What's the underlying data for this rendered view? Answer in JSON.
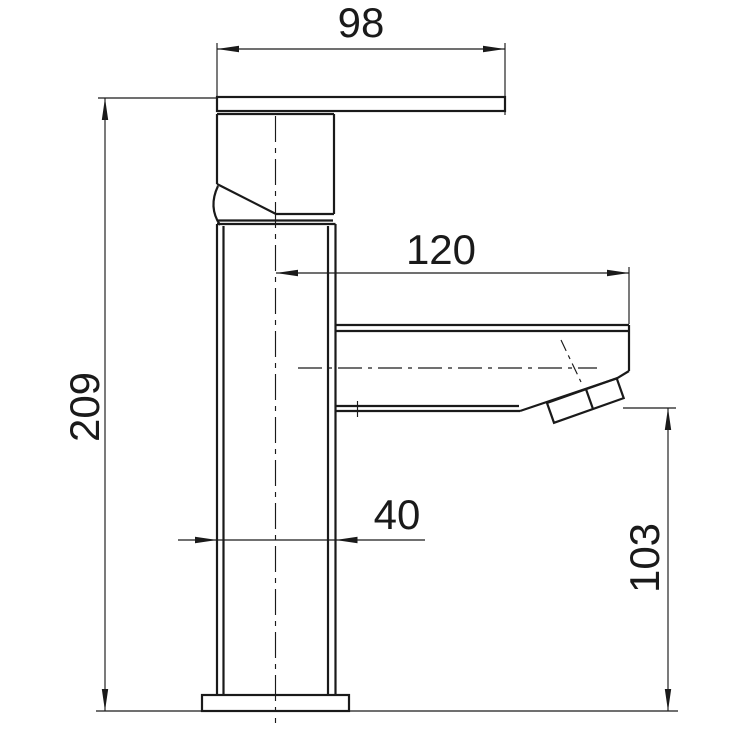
{
  "colors": {
    "line": "#1a1a1a",
    "background": "#ffffff"
  },
  "dimensions": {
    "handle_width": "98",
    "spout_reach": "120",
    "total_height": "209",
    "body_width": "40",
    "spout_outlet_height": "103"
  }
}
